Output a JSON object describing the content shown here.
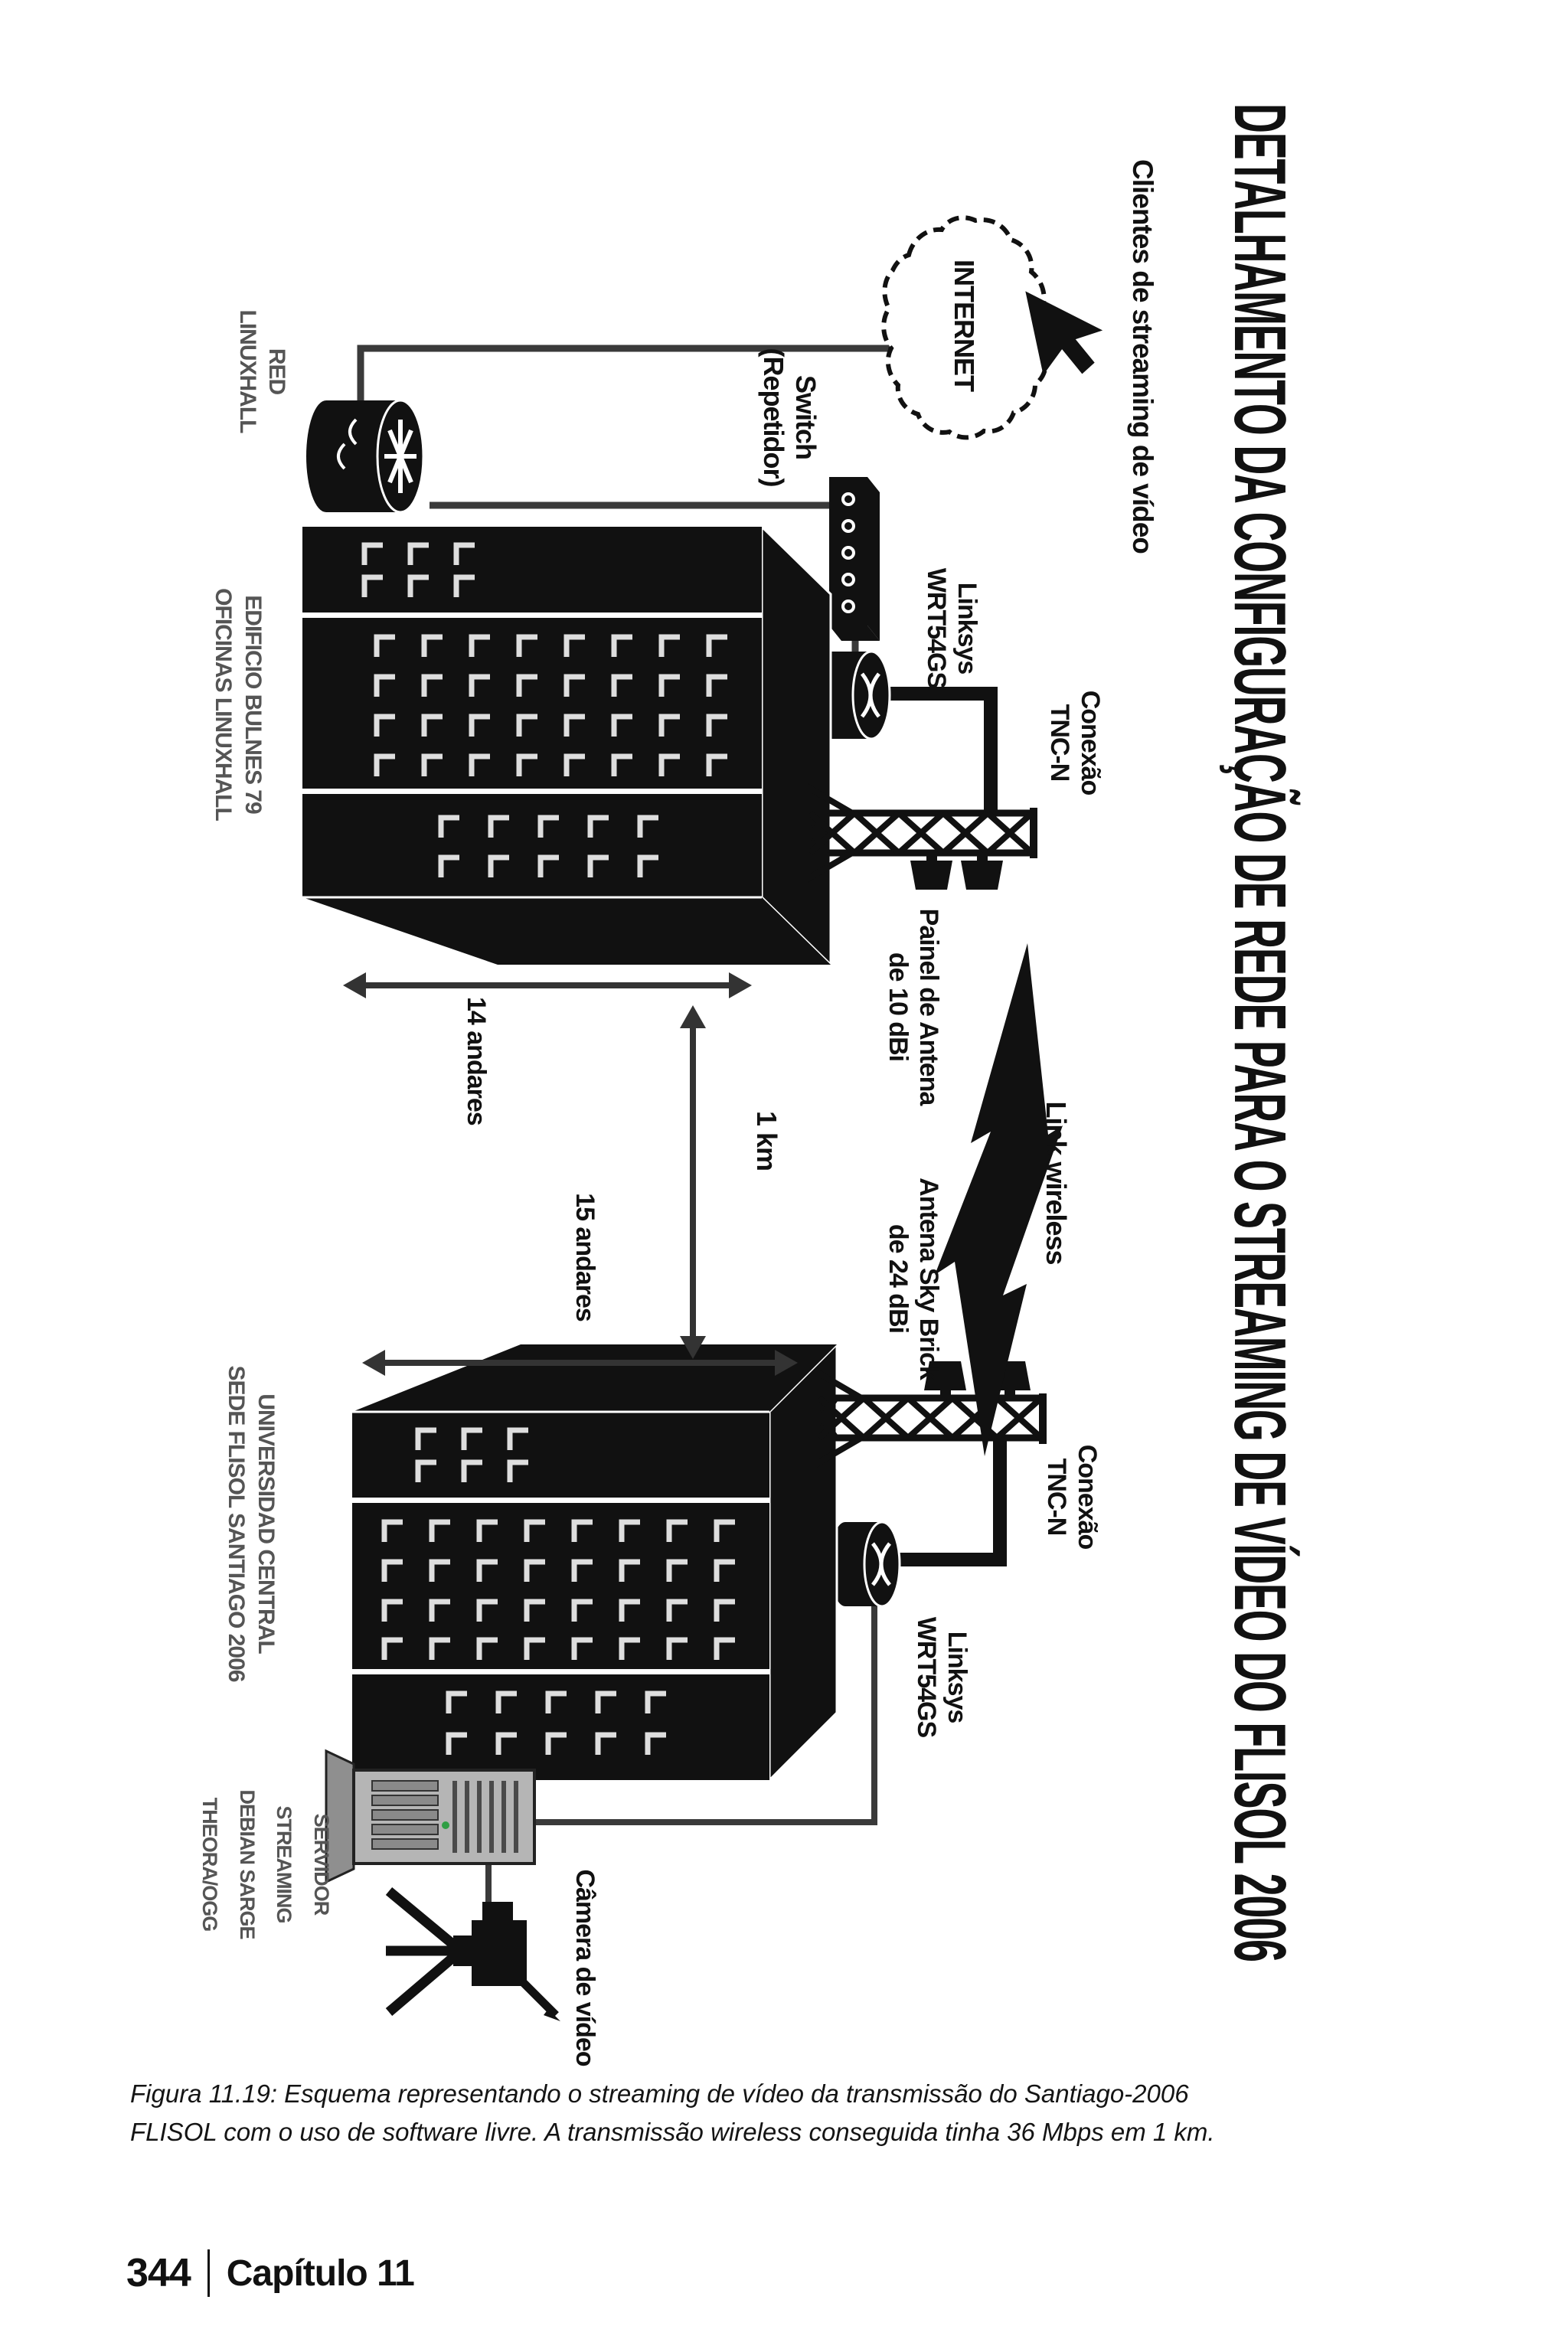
{
  "page": {
    "caption": {
      "line1": "Figura 11.19: Esquema representando o streaming de vídeo da transmissão do Santiago-2006",
      "line2": "FLISOL com o uso de software livre. A transmissão wireless conseguida tinha 36 Mbps em 1 km."
    },
    "footer": {
      "page_number": "344",
      "chapter": "Capítulo 11"
    }
  },
  "figure": {
    "title": "DETALHAMENTO DA CONFIGURAÇÃO DE REDE PARA O STREAMING DE VÍDEO DO FLISOL 2006",
    "clients_label": "Clientes de streaming de vídeo",
    "internet": "INTERNET",
    "red": {
      "l1": "RED",
      "l2": "LINUXHALL"
    },
    "switch": {
      "l1": "Switch",
      "l2": "(Repetidor)"
    },
    "linksys_top": {
      "l1": "Linksys",
      "l2": "WRT54GS"
    },
    "linksys_bottom": {
      "l1": "Linksys",
      "l2": "WRT54GS"
    },
    "conexao_top": {
      "l1": "Conexão",
      "l2": "TNC-N"
    },
    "conexao_bottom": {
      "l1": "Conexão",
      "l2": "TNC-N"
    },
    "painel": {
      "l1": "Painel de Antena",
      "l2": "de 10 dBi"
    },
    "link_wireless": "Link wireless",
    "skybrick": {
      "l1": "Antena Sky Brick",
      "l2": "de 24 dBi"
    },
    "dim": {
      "floors_top": "14 andares",
      "floors_bottom": "15 andares",
      "distance": "1 km"
    },
    "building_top": {
      "l1": "EDIFICIO BULNES 79",
      "l2": "OFICINAS LINUXHALL"
    },
    "building_bottom": {
      "l1": "UNIVERSIDAD CENTRAL",
      "l2": "SEDE FLISOL SANTIAGO 2006"
    },
    "server": {
      "lines": [
        "SERVIDOR",
        "STREAMING",
        "DEBIAN SARGE",
        "THEORA/OGG"
      ]
    },
    "camera_label": "Câmera de vídeo",
    "colors": {
      "ink": "#111111",
      "line": "#3a3a3a",
      "window": "#dedede",
      "server_body": "#b5b5b5",
      "led": "#2f9e44"
    }
  }
}
